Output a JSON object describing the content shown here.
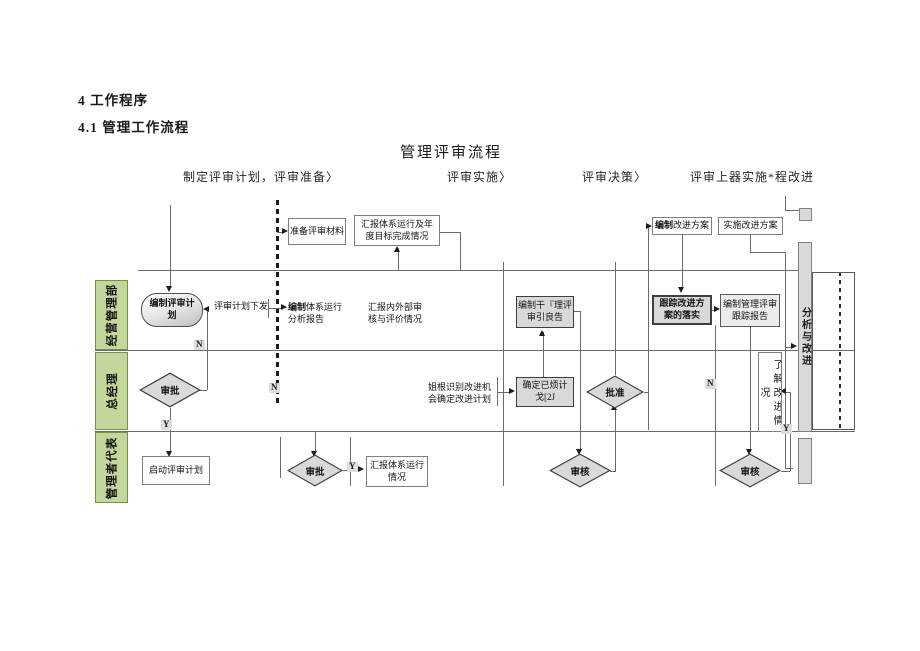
{
  "page": {
    "heading1": "4 工作程序",
    "heading2": "4.1 管理工作流程"
  },
  "flow": {
    "title": "管理评审流程",
    "phases": [
      {
        "label": "制定评审计划，评审准备〉"
      },
      {
        "label": "评审实施〉"
      },
      {
        "label": "评审决策〉"
      },
      {
        "label": "评审上器实施*程改进"
      }
    ],
    "lanes": [
      {
        "label": "经营管理部"
      },
      {
        "label": "总经理"
      },
      {
        "label": "管理者代表"
      }
    ],
    "nodes": {
      "prepare": "准备评审材料",
      "annual": "汇报体系运行及年\n度目标完成情况",
      "make_plan": "编制评审计\n划",
      "plan_issue": "评审计划下发",
      "sys_bold": "编制",
      "sys_rest": "体系运行\n分析报告",
      "audit": "汇报内外部审\n核与评价情况",
      "approve1": "审批",
      "start_plan": "启动评审计划",
      "approve2": "审批",
      "status": "汇报体系运行\n情况",
      "identify": "姐根识别改进机\n会确定改进计划",
      "confirm": "确定已烦计\n戈[2J",
      "review_report": "编制干『理评\n审引良告",
      "approve3": "批准",
      "check1": "审核",
      "check2": "审核",
      "track": "跟踪改进方\n案的落实",
      "track_report": "编制管理评审\n跟踪报告",
      "improve_bold": "编制",
      "improve_rest": "改进方案",
      "impl": "实施改进方案",
      "understand": "了解改进情况",
      "analyze": "分析与改进"
    },
    "branches": {
      "y": "Y",
      "n": "N"
    },
    "colors": {
      "lane_fill": "#c3d69b",
      "lane_border": "#76923c",
      "shape_fill": "#d9d9d9",
      "line": "#595959",
      "text": "#1a1a1a"
    }
  }
}
